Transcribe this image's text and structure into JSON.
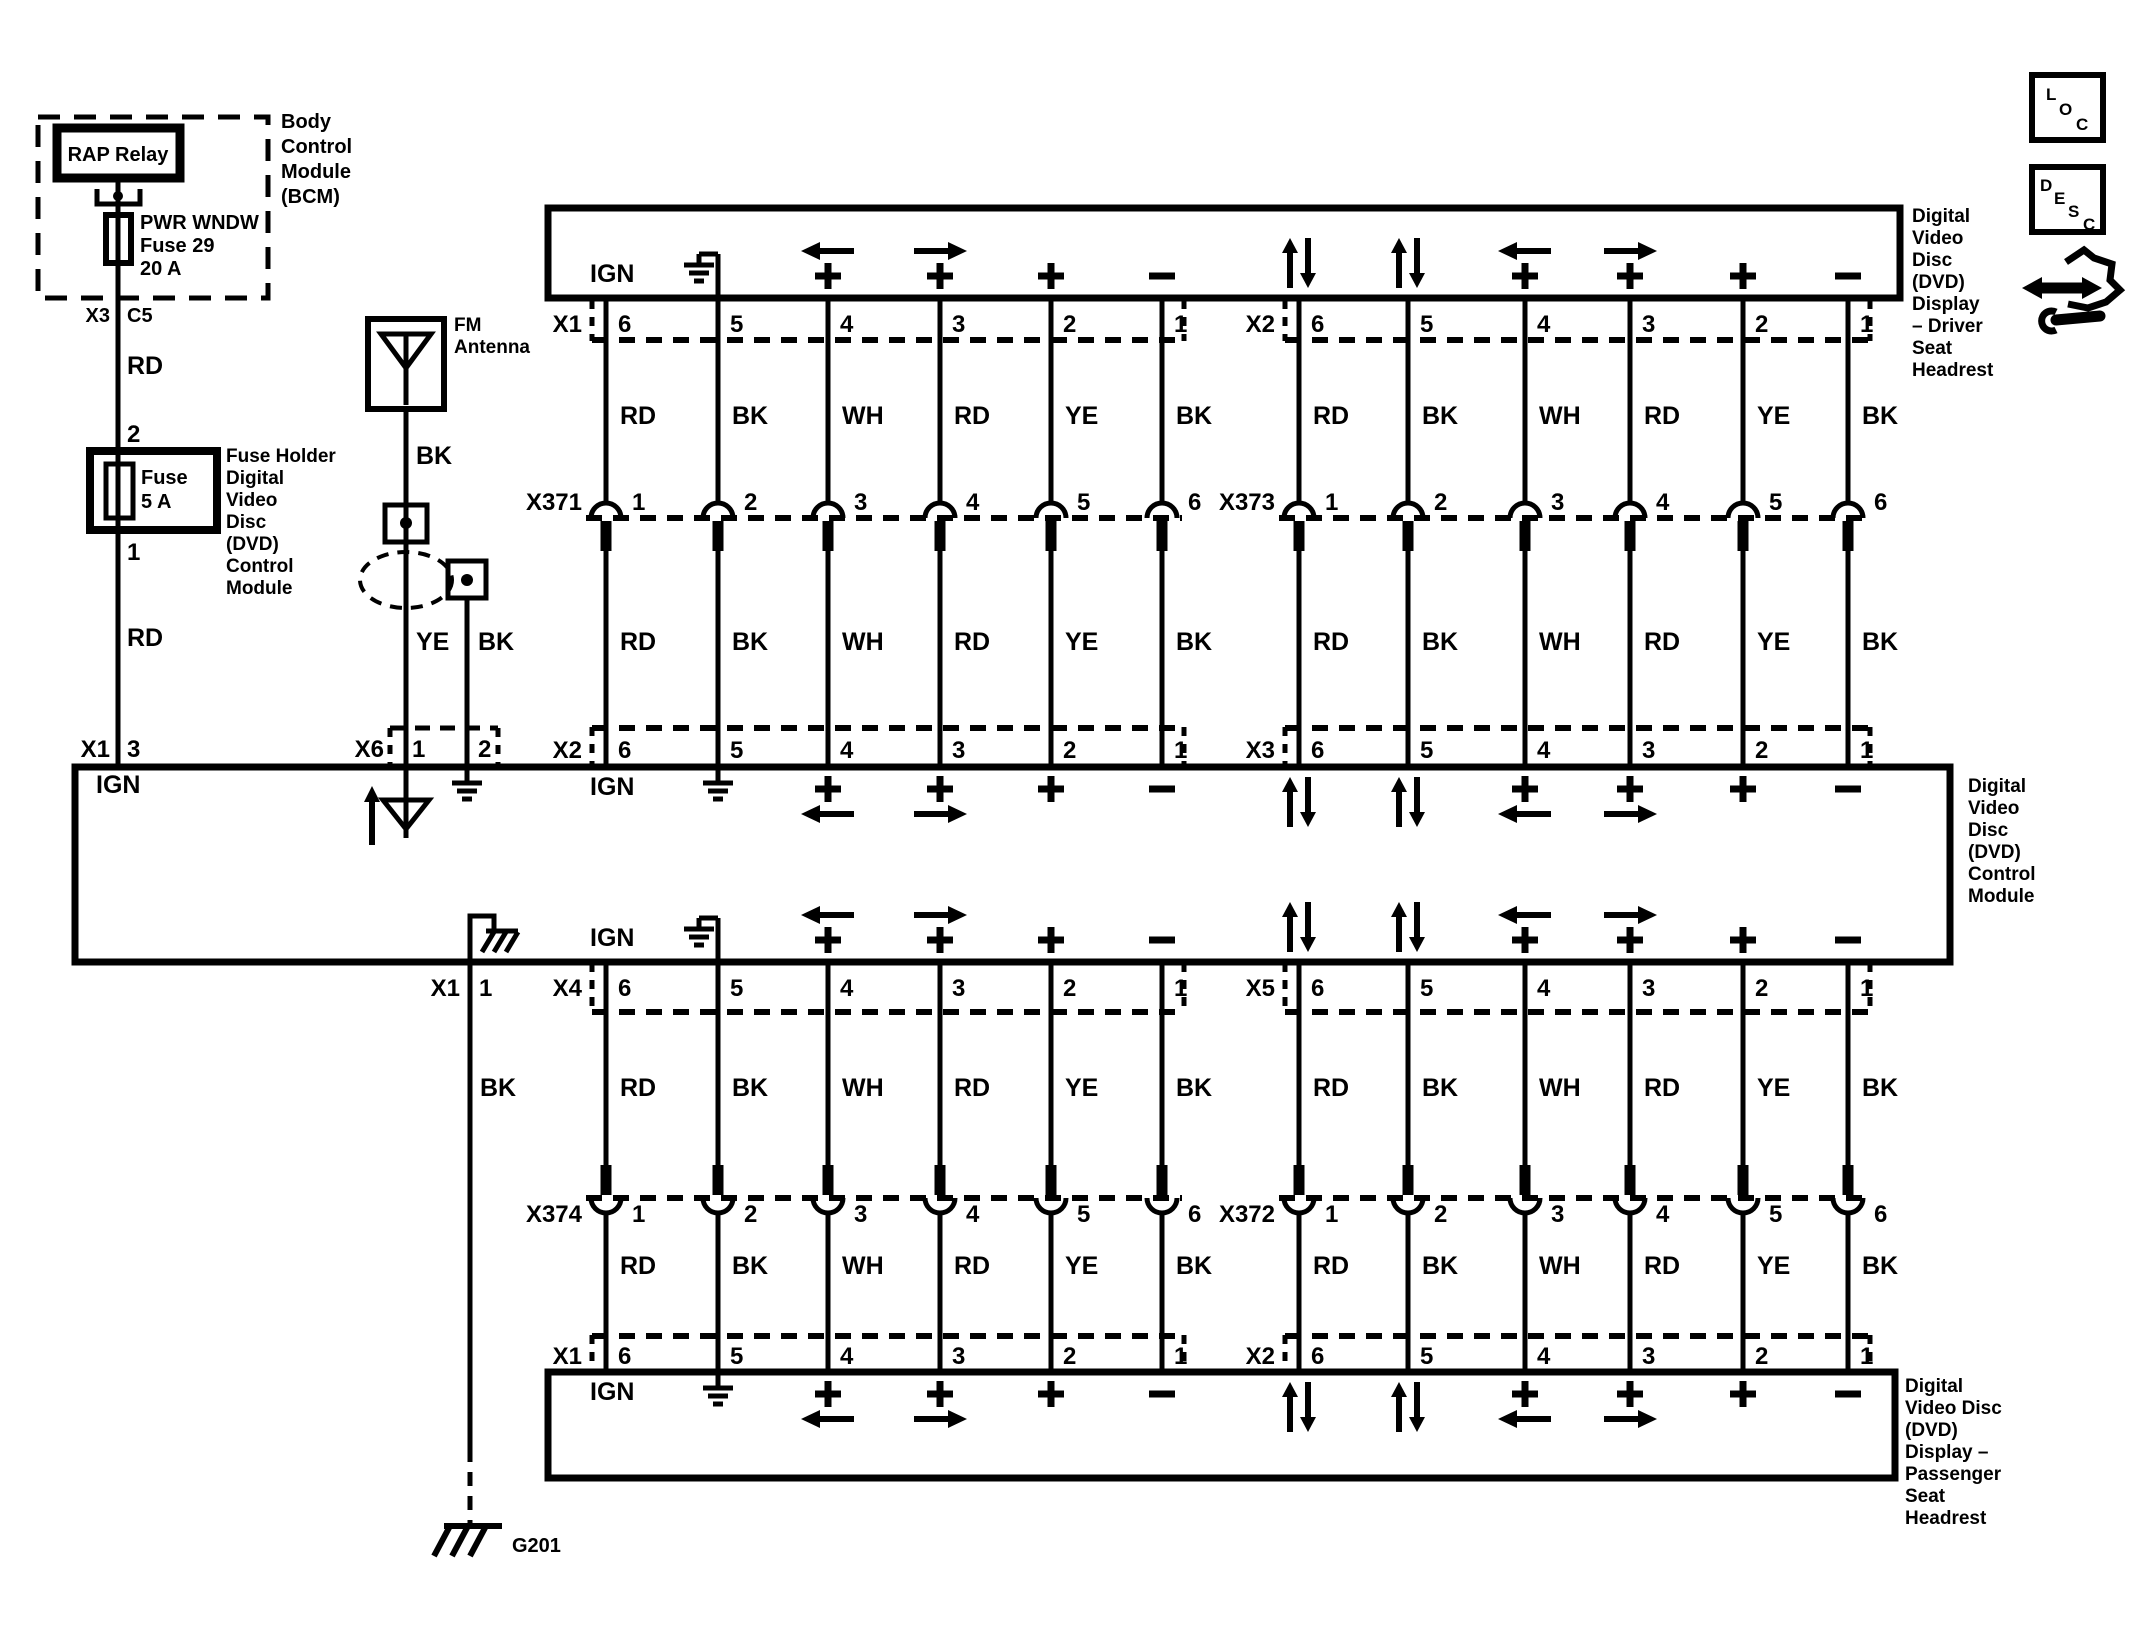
{
  "strings": {
    "ign": "IGN"
  },
  "bcm": {
    "label": [
      "Body",
      "Control",
      "Module",
      "(BCM)"
    ],
    "relay": "RAP Relay",
    "fuse": [
      "PWR WNDW",
      "Fuse 29",
      "20 A"
    ],
    "connector": "X3",
    "cavity": "C5",
    "wire": "RD",
    "pin": "2"
  },
  "holder": {
    "fuse": [
      "Fuse",
      "5 A"
    ],
    "label": [
      "Fuse Holder",
      "Digital",
      "Video",
      "Disc",
      "(DVD)",
      "Control",
      "Module"
    ],
    "pin": "1",
    "wire": "RD"
  },
  "antenna": {
    "label": [
      "FM",
      "Antenna"
    ],
    "wire": "BK",
    "conn": "X6",
    "pin1": "1",
    "pin2": "2",
    "wire1": "YE",
    "wire2": "BK"
  },
  "module": {
    "label": [
      "Digital",
      "Video",
      "Disc",
      "(DVD)",
      "Control",
      "Module"
    ],
    "ign": "IGN",
    "x1_top": {
      "conn": "X1",
      "pin": "3"
    },
    "x1_bot": {
      "conn": "X1",
      "pin": "1",
      "wire": "BK"
    },
    "ground": "G201"
  },
  "driver": {
    "label": [
      "Digital",
      "Video",
      "Disc",
      "(DVD)",
      "Display",
      "– Driver",
      "Seat",
      "Headrest"
    ]
  },
  "passenger": {
    "label": [
      "Digital",
      "Video Disc",
      "(DVD)",
      "Display –",
      "Passenger",
      "Seat",
      "Headrest"
    ]
  },
  "corner": {
    "loc": [
      "L",
      "O",
      "C"
    ],
    "desc": [
      "D",
      "E",
      "S",
      "C"
    ]
  },
  "banks": [
    {
      "quadrant": "top-left",
      "display_connector": "X1",
      "display_pins": [
        "6",
        "5",
        "4",
        "3",
        "2",
        "1"
      ],
      "colors_seg1": [
        "RD",
        "BK",
        "WH",
        "RD",
        "YE",
        "BK"
      ],
      "inline_connector": "X371",
      "inline_pins": [
        "1",
        "2",
        "3",
        "4",
        "5",
        "6"
      ],
      "colors_seg2": [
        "RD",
        "BK",
        "WH",
        "RD",
        "YE",
        "BK"
      ],
      "module_connector": "X2",
      "module_pins": [
        "6",
        "5",
        "4",
        "3",
        "2",
        "1"
      ],
      "functions": [
        "ign",
        "gnd",
        "left",
        "right",
        "plus",
        "minus"
      ]
    },
    {
      "quadrant": "top-right",
      "display_connector": "X2",
      "display_pins": [
        "6",
        "5",
        "4",
        "3",
        "2",
        "1"
      ],
      "colors_seg1": [
        "RD",
        "BK",
        "WH",
        "RD",
        "YE",
        "BK"
      ],
      "inline_connector": "X373",
      "inline_pins": [
        "1",
        "2",
        "3",
        "4",
        "5",
        "6"
      ],
      "colors_seg2": [
        "RD",
        "BK",
        "WH",
        "RD",
        "YE",
        "BK"
      ],
      "module_connector": "X3",
      "module_pins": [
        "6",
        "5",
        "4",
        "3",
        "2",
        "1"
      ],
      "functions": [
        "updown",
        "updown",
        "left",
        "right",
        "plus",
        "minus"
      ]
    },
    {
      "quadrant": "bottom-left",
      "display_connector": "X1",
      "display_pins": [
        "6",
        "5",
        "4",
        "3",
        "2",
        "1"
      ],
      "colors_seg1": [
        "RD",
        "BK",
        "WH",
        "RD",
        "YE",
        "BK"
      ],
      "inline_connector": "X374",
      "inline_pins": [
        "1",
        "2",
        "3",
        "4",
        "5",
        "6"
      ],
      "colors_seg2": [
        "RD",
        "BK",
        "WH",
        "RD",
        "YE",
        "BK"
      ],
      "module_connector": "X4",
      "module_pins": [
        "6",
        "5",
        "4",
        "3",
        "2",
        "1"
      ],
      "functions": [
        "ign",
        "gnd",
        "left",
        "right",
        "plus",
        "minus"
      ]
    },
    {
      "quadrant": "bottom-right",
      "display_connector": "X2",
      "display_pins": [
        "6",
        "5",
        "4",
        "3",
        "2",
        "1"
      ],
      "colors_seg1": [
        "RD",
        "BK",
        "WH",
        "RD",
        "YE",
        "BK"
      ],
      "inline_connector": "X372",
      "inline_pins": [
        "1",
        "2",
        "3",
        "4",
        "5",
        "6"
      ],
      "colors_seg2": [
        "RD",
        "BK",
        "WH",
        "RD",
        "YE",
        "BK"
      ],
      "module_connector": "X5",
      "module_pins": [
        "6",
        "5",
        "4",
        "3",
        "2",
        "1"
      ],
      "functions": [
        "updown",
        "updown",
        "left",
        "right",
        "plus",
        "minus"
      ]
    }
  ]
}
